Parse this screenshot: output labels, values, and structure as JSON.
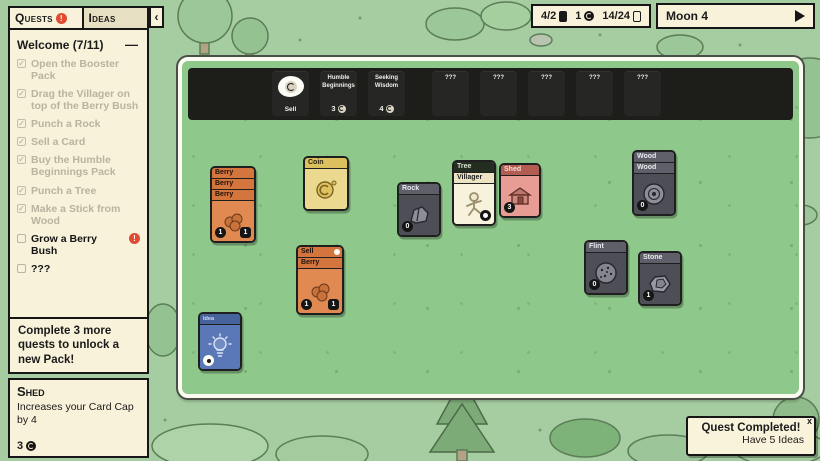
{
  "colors": {
    "background_green": "#a6cda2",
    "board_green": "#8fc88b",
    "panel_cream": "#f8f2da",
    "alert_red": "#e14b32",
    "strip_black": "#1d1d1a",
    "card_orange": "#e08a52",
    "card_yellow": "#ead98f",
    "card_gray": "#4e4e57",
    "card_pink": "#e79d93",
    "card_blue": "#5a78b8"
  },
  "quests_panel": {
    "tabs": {
      "quests": "Quests",
      "ideas": "Ideas"
    },
    "alert_glyph": "!",
    "collapse_glyph": "‹",
    "group_title": "Welcome (7/11)",
    "group_collapse_glyph": "—",
    "check_glyph": "✓",
    "quests": [
      {
        "label": "Open the Booster Pack",
        "done": true
      },
      {
        "label": "Drag the Villager on top of the Berry Bush",
        "done": true
      },
      {
        "label": "Punch a Rock",
        "done": true
      },
      {
        "label": "Sell a Card",
        "done": true
      },
      {
        "label": "Buy the Humble Beginnings Pack",
        "done": true
      },
      {
        "label": "Punch a Tree",
        "done": true
      },
      {
        "label": "Make a Stick from Wood",
        "done": true
      },
      {
        "label": "Grow a Berry Bush",
        "done": false,
        "alert": "!"
      },
      {
        "label": "???",
        "done": false
      }
    ],
    "footer_note": "Complete 3 more quests to unlock a new Pack!"
  },
  "tooltip_panel": {
    "title": "Shed",
    "description": "Increases your Card Cap by 4",
    "coin_value": "3"
  },
  "top_bar": {
    "cards_in_play": "4/2",
    "coins": "1",
    "card_cap": "14/24",
    "moon_label": "Moon 4"
  },
  "board": {
    "sell_slot_label": "Sell",
    "packs": [
      {
        "name": "Humble Beginnings",
        "price": "3"
      },
      {
        "name": "Seeking Wisdom",
        "price": "4"
      },
      {
        "name": "???"
      },
      {
        "name": "???"
      },
      {
        "name": "???"
      },
      {
        "name": "???"
      },
      {
        "name": "???"
      }
    ],
    "cards": {
      "berry_stack": {
        "headers": [
          "Berry",
          "Berry",
          "Berry"
        ],
        "coin_value": "1",
        "food_value": "1"
      },
      "coin": {
        "title": "Coin"
      },
      "rock": {
        "title": "Rock",
        "coin_value": "0"
      },
      "tree_villager": {
        "stack_header": "Tree",
        "title": "Villager"
      },
      "shed": {
        "title": "Shed",
        "coin_value": "3"
      },
      "wood_stack": {
        "headers": [
          "Wood",
          "Wood"
        ],
        "coin_value": "0"
      },
      "sell_berry": {
        "stack_header": "Sell",
        "title": "Berry",
        "coin_value": "1",
        "food_value": "1"
      },
      "flint": {
        "title": "Flint",
        "coin_value": "0"
      },
      "stone": {
        "title": "Stone",
        "coin_value": "1"
      },
      "idea": {
        "title": "Idea"
      }
    }
  },
  "toast": {
    "title": "Quest Completed!",
    "subtitle": "Have 5 Ideas",
    "close_glyph": "x"
  }
}
